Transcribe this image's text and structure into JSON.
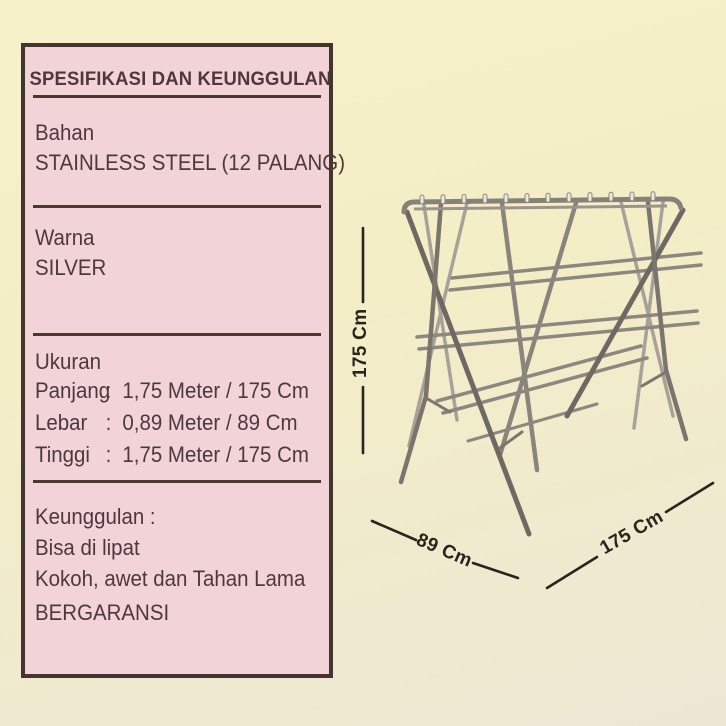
{
  "canvas": {
    "background_top_color": "#f7f1c9",
    "background_bottom_color": "#ece7d4"
  },
  "spec_panel": {
    "title": "SPESIFIKASI DAN KEUNGGULAN",
    "panel_bg_color": "#f2d3d8",
    "border_color": "#443530",
    "text_color": "#4e383c",
    "bahan": {
      "label": "Bahan",
      "value": "STAINLESS STEEL (12 PALANG)"
    },
    "warna": {
      "label": "Warna",
      "value": "SILVER"
    },
    "ukuran": {
      "label": "Ukuran",
      "rows": [
        {
          "name": "Panjang",
          "sep": ":",
          "value": "1,75 Meter / 175 Cm"
        },
        {
          "name": "Lebar",
          "sep": ":",
          "value": "0,89 Meter / 89 Cm"
        },
        {
          "name": "Tinggi",
          "sep": ":",
          "value": "1,75 Meter / 175 Cm"
        }
      ]
    },
    "keunggulan": {
      "label": "Keunggulan :",
      "items": [
        "Bisa di lipat",
        "Kokoh, awet dan Tahan Lama",
        "BERGARANSI"
      ]
    }
  },
  "product": {
    "subject": "stainless-steel-folding-drying-rack",
    "dimensions": {
      "height_label": "175 Cm",
      "width_label": "89 Cm",
      "length_label": "175 Cm"
    },
    "annotation_color": "#2b241e"
  }
}
